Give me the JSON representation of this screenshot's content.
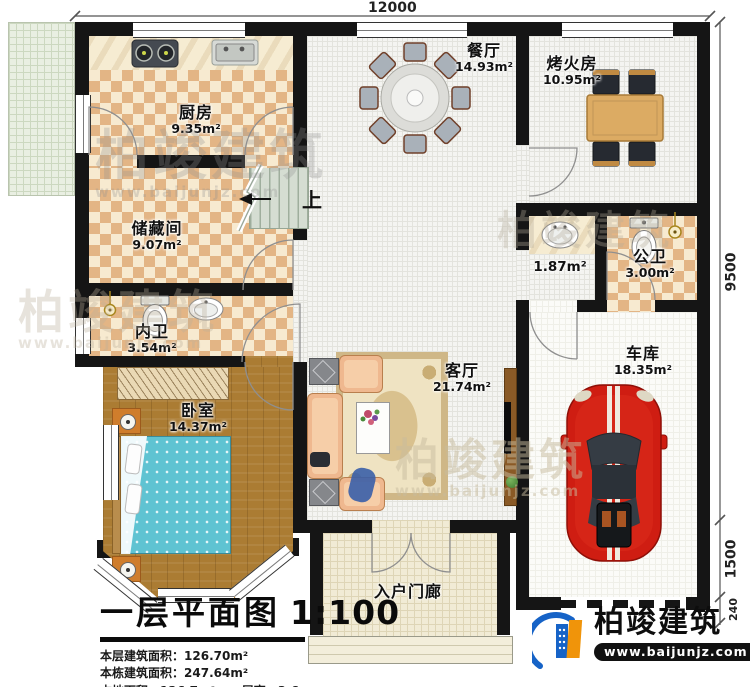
{
  "plan": {
    "dims": {
      "top": "12000",
      "right_main": "9500",
      "right_garage": "1500",
      "right_wall": "240"
    },
    "rooms": {
      "kitchen": {
        "label": "厨房",
        "area": "9.35m²"
      },
      "dining": {
        "label": "餐厅",
        "area": "14.93m²"
      },
      "fire_room": {
        "label": "烤火房",
        "area": "10.95m²"
      },
      "storage": {
        "label": "储藏间",
        "area": "9.07m²"
      },
      "wash_nook": {
        "label": "",
        "area": "1.87m²"
      },
      "public_wc": {
        "label": "公卫",
        "area": "3.00m²"
      },
      "private_wc": {
        "label": "内卫",
        "area": "3.54m²"
      },
      "bedroom": {
        "label": "卧室",
        "area": "14.37m²"
      },
      "living": {
        "label": "客厅",
        "area": "21.74m²"
      },
      "garage": {
        "label": "车库",
        "area": "18.35m²"
      },
      "porch": {
        "label": "入户门廊",
        "area": ""
      }
    },
    "stairs_up": "上"
  },
  "title_block": {
    "title": "一层平面图",
    "scale": "1:100",
    "stats": [
      {
        "label": "本层建筑面积：",
        "value": "126.70m²"
      },
      {
        "label": "本栋建筑面积：",
        "value": "247.64m²"
      },
      {
        "label": "占地面积：",
        "value": "126.7m²"
      },
      {
        "label": "层高：",
        "value": "3.6m"
      }
    ]
  },
  "brand": {
    "name": "柏竣建筑",
    "url": "www.baijunjz.com"
  },
  "watermark": {
    "name": "柏竣建筑",
    "url": "www.baijunjz.com"
  }
}
